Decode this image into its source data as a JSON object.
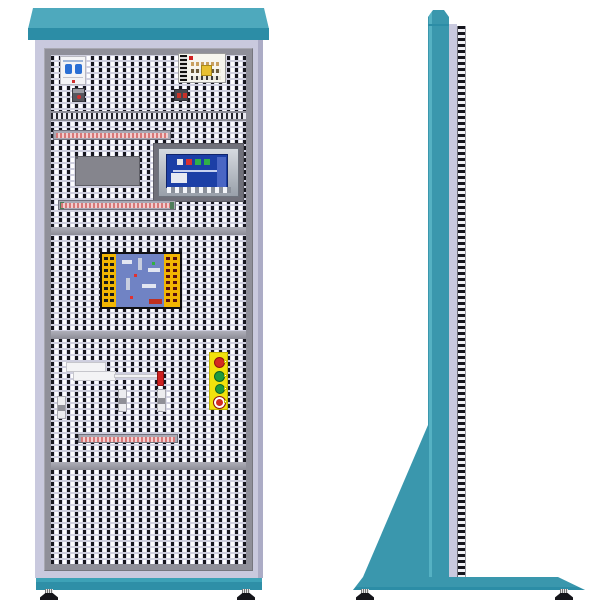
{
  "figure": {
    "kind": "technical-illustration",
    "subject": "Electrical control training cabinet",
    "views": [
      "front-view",
      "side-view"
    ],
    "visible_text": ""
  },
  "palette": {
    "teal_top": "#4EA9BD",
    "teal_main": "#3A97AD",
    "teal_band": "#2C8DA6",
    "body_lavender": "#C9C9DE",
    "frame_gray": "#8F8F99",
    "perforation_light": "#DCDCEA",
    "perforation_dark": "#17171F",
    "terminal_strip_red": "#D87878",
    "station_yellow": "#F2E20C",
    "button_red": "#D42B20",
    "button_green": "#1E9A40",
    "hmi_screen_blue": "#1C3FA6",
    "pcb_yellow": "#F2B602",
    "pcb_blue": "#7083C4",
    "foot_black": "#15151A"
  },
  "front_view": {
    "rows": [
      {
        "row": 1,
        "components": [
          "miniature-circuit-breaker",
          "relay-block",
          "switching-power-supply",
          "fuse-terminal"
        ]
      },
      {
        "row": 2,
        "components": [
          "terminal-strip",
          "plc-module",
          "hmi-touch-panel",
          "terminal-strip"
        ]
      },
      {
        "row": 3,
        "components": [
          "io-interface-board"
        ]
      },
      {
        "row": 4,
        "components": [
          "cable-ducts",
          "pilot-indicator",
          "miniature-relays",
          "pushbutton-station",
          "terminal-strip"
        ]
      },
      {
        "row": 5,
        "components": []
      }
    ],
    "pushbutton_station": {
      "buttons": [
        "red-pushbutton",
        "green-pushbutton",
        "green-pushbutton",
        "emergency-stop-mushroom"
      ]
    },
    "hmi_screen_indicators": [
      "white",
      "red",
      "green",
      "green"
    ],
    "feet_count": 2
  },
  "side_view": {
    "parts": [
      "chamfered-top-cap",
      "upright-column",
      "panel-edge-strip",
      "component-ladder-strip",
      "support-gusset",
      "floor-base",
      "leveling-feet"
    ],
    "feet_count": 2
  }
}
